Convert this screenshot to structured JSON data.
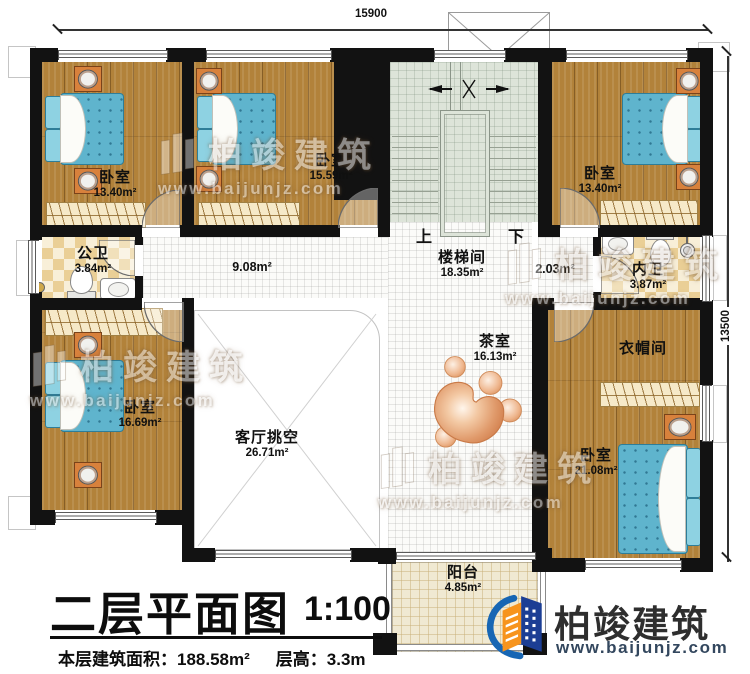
{
  "title_block": {
    "title": "二层平面图",
    "scale": "1:100",
    "area_label": "本层建筑面积：",
    "area_value": "188.58m²",
    "floor_height_label": "层高：",
    "floor_height_value": "3.3m"
  },
  "dimensions": {
    "top": "15900",
    "right": "13500"
  },
  "stairs": {
    "up": "上",
    "down": "下"
  },
  "rooms": [
    {
      "id": "bedroom-top-left",
      "name": "卧室",
      "area": "13.40m²"
    },
    {
      "id": "bedroom-top-middle",
      "name": "卧室",
      "area": "15.59m²"
    },
    {
      "id": "bedroom-top-right",
      "name": "卧室",
      "area": "13.40m²"
    },
    {
      "id": "public-bathroom",
      "name": "公卫",
      "area": "3.84m²"
    },
    {
      "id": "hallway",
      "name": "",
      "area": "9.08m²"
    },
    {
      "id": "stairwell",
      "name": "楼梯间",
      "area": "18.35m²"
    },
    {
      "id": "vestibule",
      "name": "",
      "area": "2.03m²"
    },
    {
      "id": "ensuite-bathroom",
      "name": "内卫",
      "area": "3.87m²"
    },
    {
      "id": "bedroom-middle-left",
      "name": "卧室",
      "area": "16.69m²"
    },
    {
      "id": "living-room-void",
      "name": "客厅挑空",
      "area": "26.71m²"
    },
    {
      "id": "tea-room",
      "name": "茶室",
      "area": "16.13m²"
    },
    {
      "id": "cloakroom",
      "name": "衣帽间",
      "area": ""
    },
    {
      "id": "bedroom-bottom-right",
      "name": "卧室",
      "area": "21.08m²"
    },
    {
      "id": "balcony",
      "name": "阳台",
      "area": "4.85m²"
    }
  ],
  "brand": {
    "name": "柏竣建筑",
    "website": "www.baijunjz.com"
  },
  "watermark": {
    "name": "柏竣建筑",
    "website": "www.baijunjz.com"
  },
  "colors": {
    "wall": "#121212",
    "wood_floor": "#b2823a",
    "tile_checker": "#eacf96",
    "stair_floor": "#dde4d9",
    "balcony_floor": "#f0e9d2",
    "mattress_blue": "#5fb4cd",
    "nightstand_orange": "#d8813c",
    "brand_blue": "#1766b4",
    "brand_navy": "#1c3e94",
    "brand_orange": "#f7941d"
  }
}
